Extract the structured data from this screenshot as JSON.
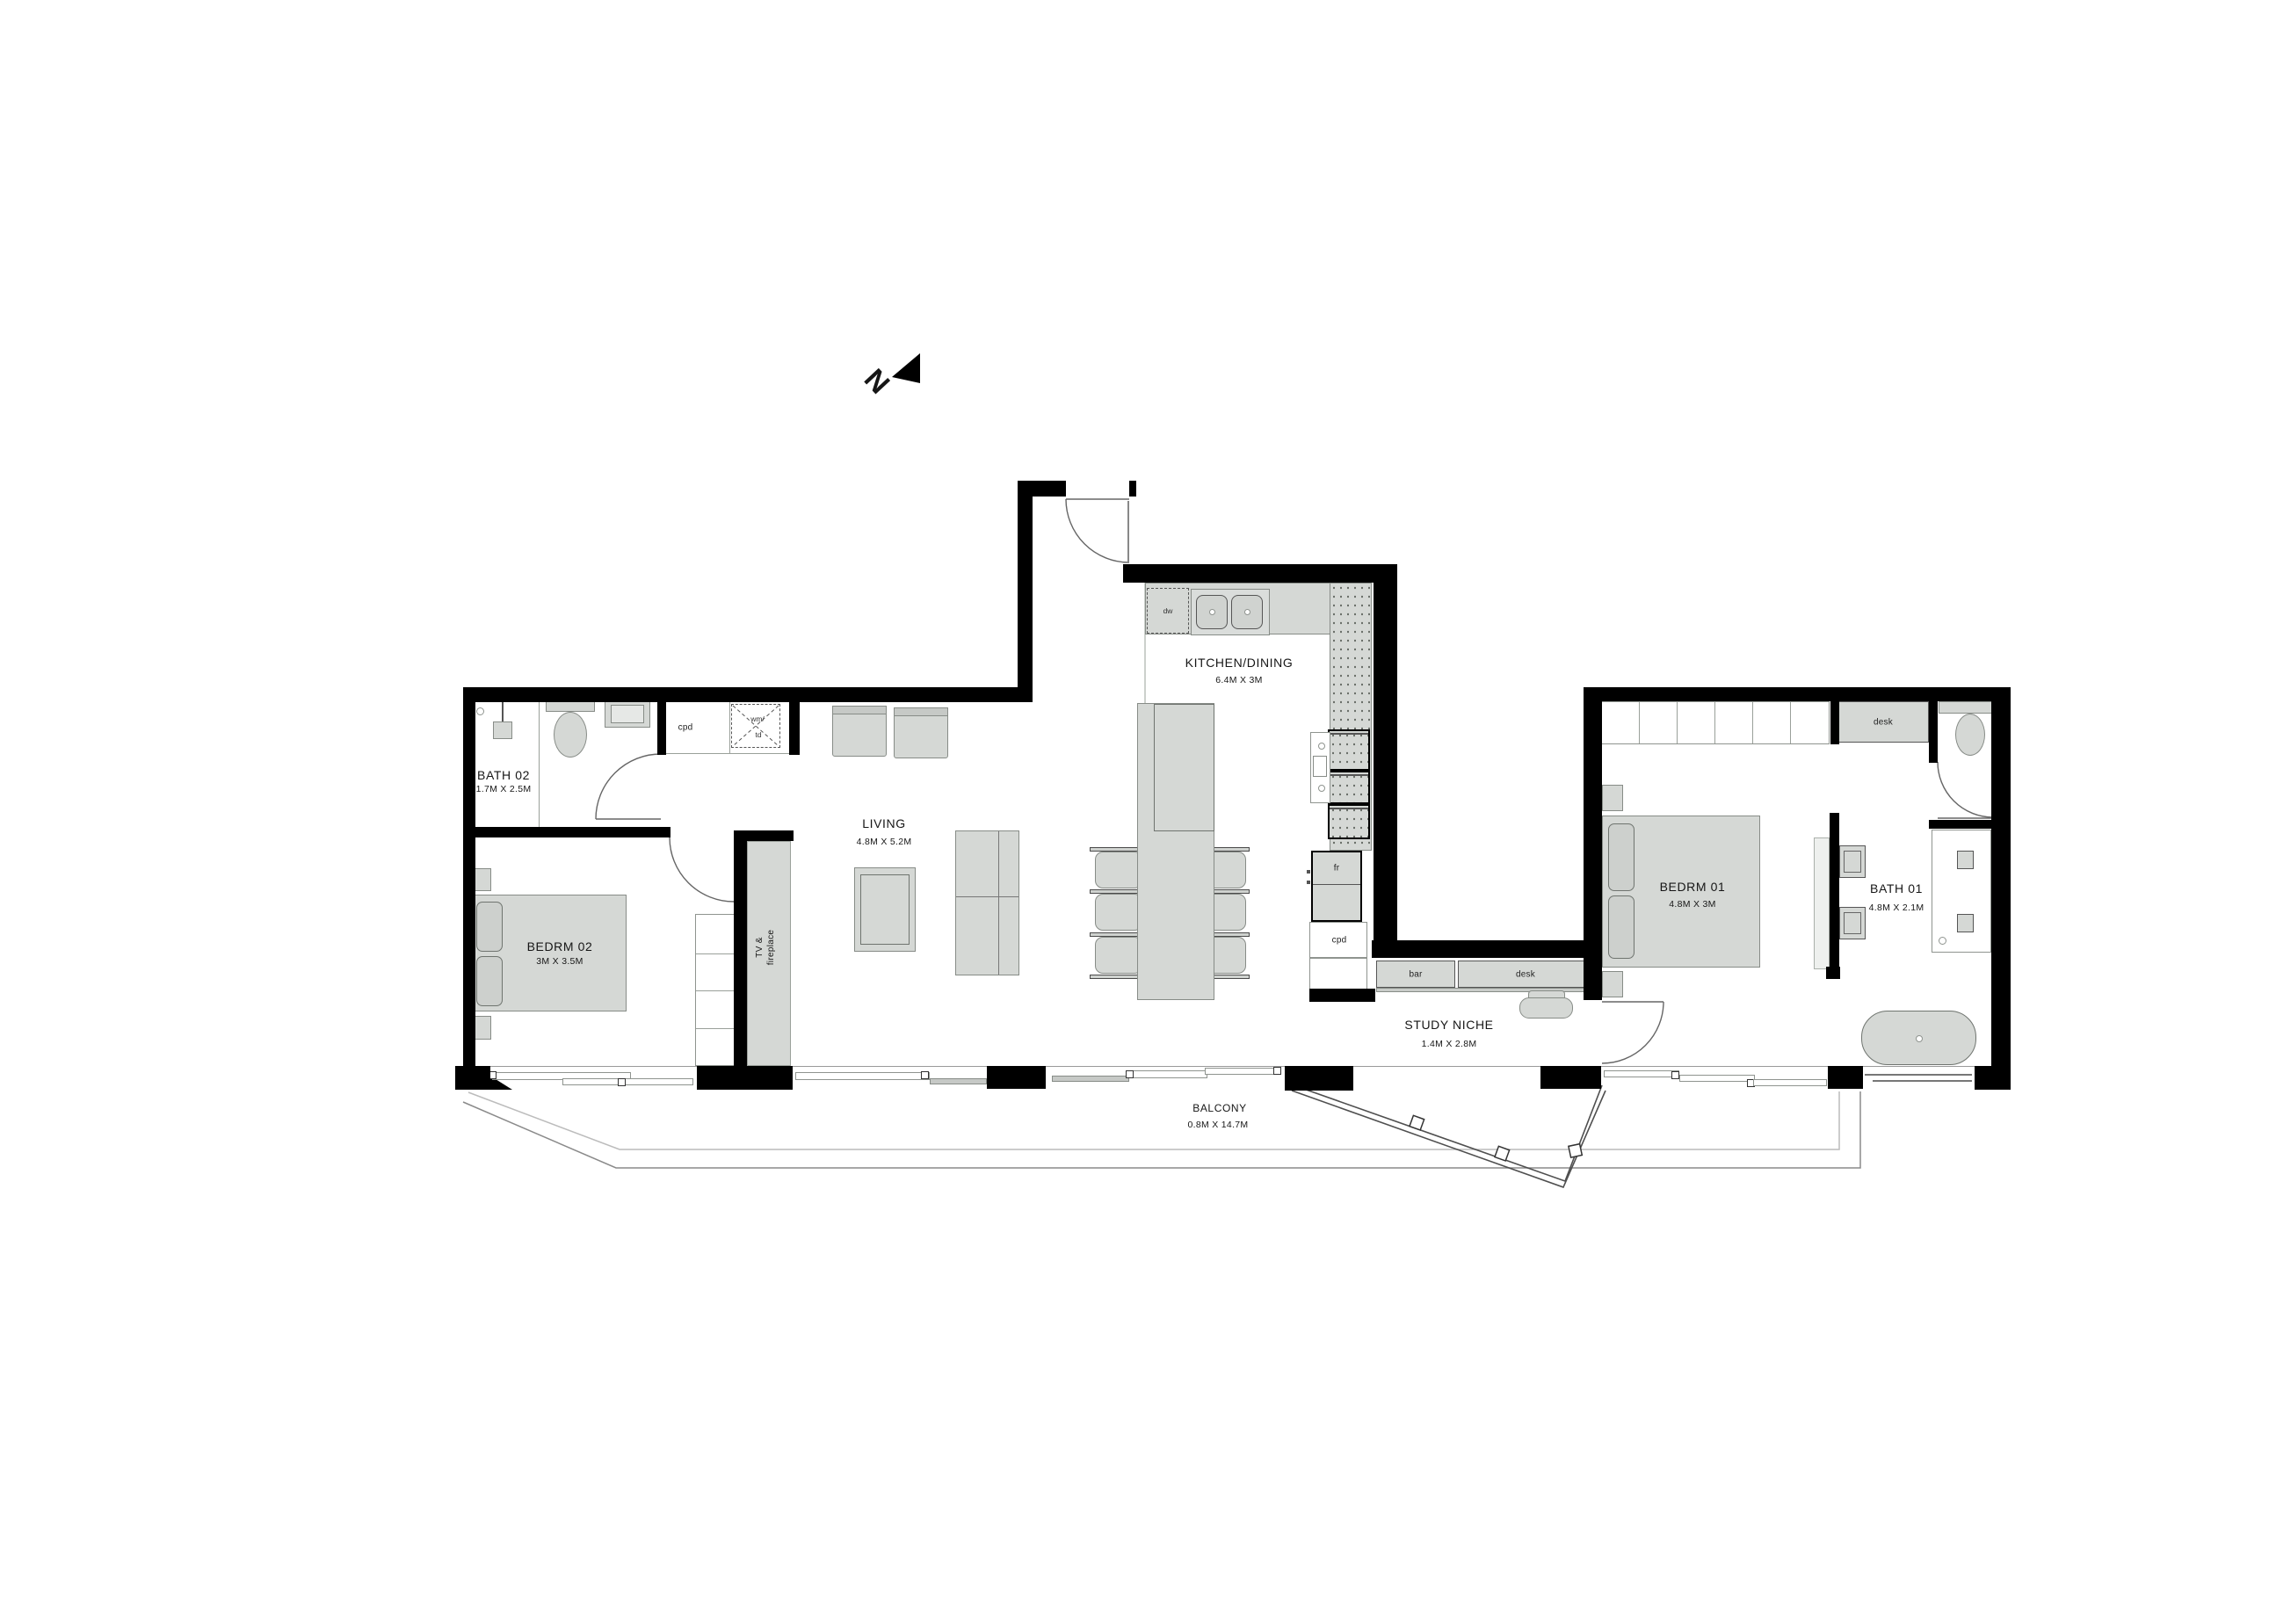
{
  "north": {
    "letter": "N"
  },
  "rooms": [
    {
      "name": "BATH 02",
      "dims": "1.7M X 2.5M"
    },
    {
      "name": "BEDRM 02",
      "dims": "3M X 3.5M"
    },
    {
      "name": "LIVING",
      "dims": "4.8M X 5.2M"
    },
    {
      "name": "KITCHEN/DINING",
      "dims": "6.4M X 3M"
    },
    {
      "name": "STUDY NICHE",
      "dims": "1.4M X 2.8M"
    },
    {
      "name": "BEDRM 01",
      "dims": "4.8M X 3M"
    },
    {
      "name": "BATH 01",
      "dims": "4.8M X 2.1M"
    },
    {
      "name": "BALCONY",
      "dims": "0.8M X 14.7M"
    }
  ],
  "fixtures": {
    "cupboard_hall": "cpd",
    "washing_machine": "wm/",
    "tumble_dryer": "td",
    "dishwasher": "dw",
    "fridge": "fr",
    "cupboard_kitchen": "cpd",
    "bar_counter": "bar",
    "study_desk": "desk",
    "bedroom_desk": "desk",
    "tv_line1": "TV &",
    "tv_line2": "fireplace"
  },
  "colors": {
    "wall": "#000000",
    "furniture_fill": "#d5d8d5",
    "outline": "#878c87",
    "text": "#161616"
  }
}
